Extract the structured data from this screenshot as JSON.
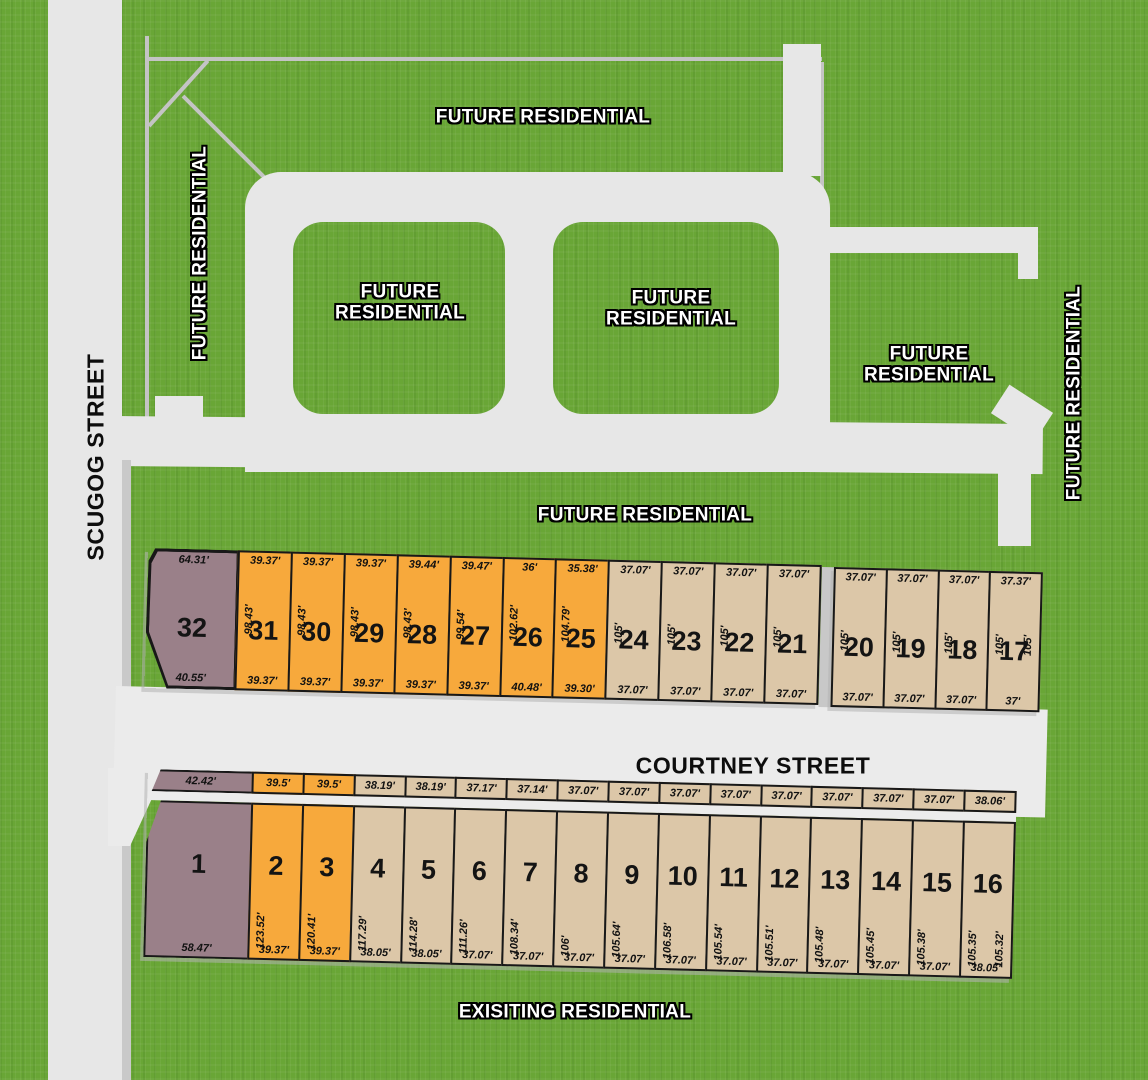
{
  "streets": {
    "scugog": "SCUGOG STREET",
    "courtney": "COURTNEY STREET"
  },
  "labels": {
    "future_residential": "FUTURE RESIDENTIAL",
    "existing_residential": "EXISITING RESIDENTIAL"
  },
  "colors": {
    "grass": "#69a636",
    "road": "#e7e7e7",
    "road_line": "#c4c4c4",
    "lot_tan": "#dcc7a8",
    "lot_orange": "#f7a93c",
    "lot_purple": "#9a8089",
    "lot_border": "#181818"
  },
  "blocks": {
    "north_west": {
      "row": "top",
      "lots": [
        {
          "number": "32",
          "color": "purple",
          "wide": true,
          "front": "64.31'",
          "rear": "40.55'"
        },
        {
          "number": "31",
          "color": "orange",
          "front": "39.37'",
          "side": "98.43'",
          "rear": "39.37'"
        },
        {
          "number": "30",
          "color": "orange",
          "front": "39.37'",
          "side": "98.43'",
          "rear": "39.37'"
        },
        {
          "number": "29",
          "color": "orange",
          "front": "39.37'",
          "side": "98.43'",
          "rear": "39.37'"
        },
        {
          "number": "28",
          "color": "orange",
          "front": "39.44'",
          "side": "98.43'",
          "rear": "39.37'"
        },
        {
          "number": "27",
          "color": "orange",
          "front": "39.47'",
          "side": "99.54'",
          "rear": "39.37'"
        },
        {
          "number": "26",
          "color": "orange",
          "front": "36'",
          "side": "102.62'",
          "rear": "40.48'"
        },
        {
          "number": "25",
          "color": "orange",
          "front": "35.38'",
          "side": "104.79'",
          "rear": "39.30'"
        },
        {
          "number": "24",
          "color": "tan",
          "front": "37.07'",
          "side": "105'",
          "rear": "37.07'"
        },
        {
          "number": "23",
          "color": "tan",
          "front": "37.07'",
          "side": "105'",
          "rear": "37.07'"
        },
        {
          "number": "22",
          "color": "tan",
          "front": "37.07'",
          "side": "105'",
          "rear": "37.07'"
        },
        {
          "number": "21",
          "color": "tan",
          "front": "37.07'",
          "side": "105'",
          "rear": "37.07'"
        }
      ]
    },
    "north_east": {
      "row": "top",
      "lots": [
        {
          "number": "20",
          "color": "tan",
          "front": "37.07'",
          "side": "105'",
          "rear": "37.07'"
        },
        {
          "number": "19",
          "color": "tan",
          "front": "37.07'",
          "side": "105'",
          "rear": "37.07'"
        },
        {
          "number": "18",
          "color": "tan",
          "front": "37.07'",
          "side": "105'",
          "rear": "37.07'"
        },
        {
          "number": "17",
          "color": "tan",
          "front": "37.37'",
          "side": "105'",
          "side_right": "105'",
          "rear": "37'"
        }
      ]
    },
    "south": {
      "row": "bottom",
      "lots": [
        {
          "number": "1",
          "color": "purple",
          "wide": true,
          "front": "42.42'",
          "rear": "58.47'"
        },
        {
          "number": "2",
          "color": "orange",
          "front": "39.5'",
          "side": "123.52'",
          "rear": "39.37'"
        },
        {
          "number": "3",
          "color": "orange",
          "front": "39.5'",
          "side": "120.41'",
          "rear": "39.37'"
        },
        {
          "number": "4",
          "color": "tan",
          "front": "38.19'",
          "side": "117.29'",
          "rear": "38.05'"
        },
        {
          "number": "5",
          "color": "tan",
          "front": "38.19'",
          "side": "114.28'",
          "rear": "38.05'"
        },
        {
          "number": "6",
          "color": "tan",
          "front": "37.17'",
          "side": "111.26'",
          "rear": "37.07'"
        },
        {
          "number": "7",
          "color": "tan",
          "front": "37.14'",
          "side": "108.34'",
          "rear": "37.07'"
        },
        {
          "number": "8",
          "color": "tan",
          "front": "37.07'",
          "side": "106'",
          "rear": "37.07'"
        },
        {
          "number": "9",
          "color": "tan",
          "front": "37.07'",
          "side": "105.64'",
          "rear": "37.07'"
        },
        {
          "number": "10",
          "color": "tan",
          "front": "37.07'",
          "side": "106.58'",
          "rear": "37.07'"
        },
        {
          "number": "11",
          "color": "tan",
          "front": "37.07'",
          "side": "105.54'",
          "rear": "37.07'"
        },
        {
          "number": "12",
          "color": "tan",
          "front": "37.07'",
          "side": "105.51'",
          "rear": "37.07'"
        },
        {
          "number": "13",
          "color": "tan",
          "front": "37.07'",
          "side": "105.48'",
          "rear": "37.07'"
        },
        {
          "number": "14",
          "color": "tan",
          "front": "37.07'",
          "side": "105.45'",
          "rear": "37.07'"
        },
        {
          "number": "15",
          "color": "tan",
          "front": "37.07'",
          "side": "105.38'",
          "rear": "37.07'"
        },
        {
          "number": "16",
          "color": "tan",
          "front": "38.06'",
          "side": "105.35'",
          "side_right": "105.32'",
          "rear": "38.05'"
        }
      ]
    }
  }
}
